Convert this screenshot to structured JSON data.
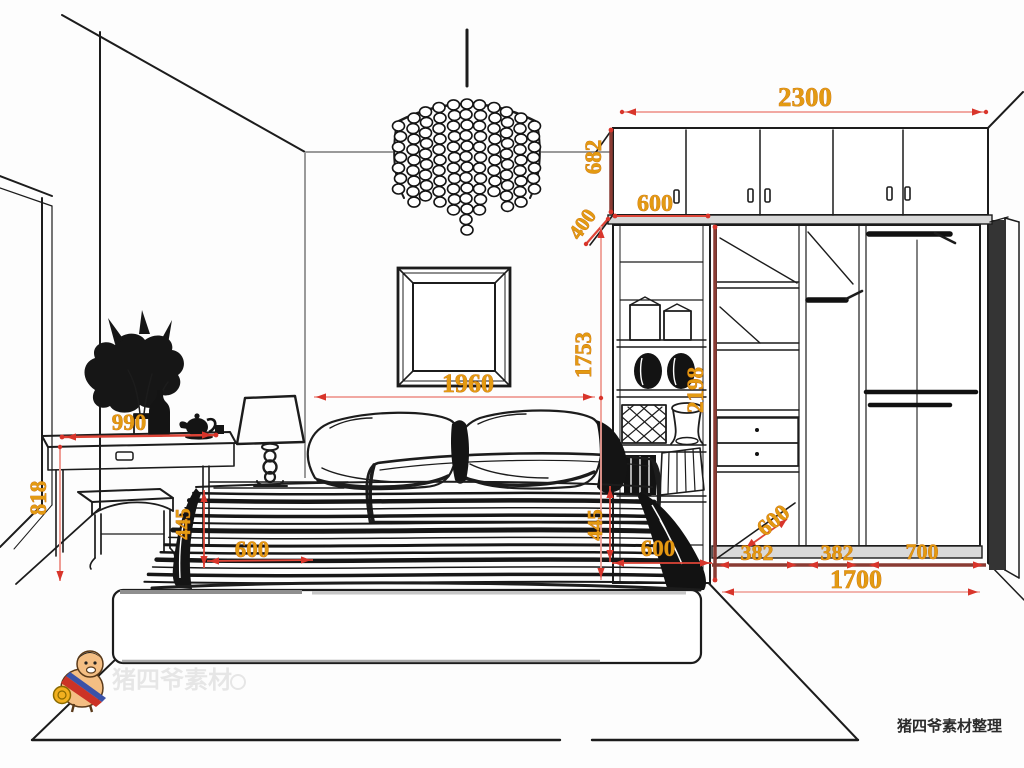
{
  "diagram": {
    "credit_text": "猪四爷素材整理",
    "watermark_text": "猪四爷素材",
    "dimensions": {
      "top_cabinet_width": "2300",
      "top_cabinet_height": "682",
      "bookshelf_width": "600",
      "top_cabinet_depth": "400",
      "bookshelf_height": "1753",
      "wardrobe_height": "2198",
      "bed_width": "1960",
      "dresser_width": "990",
      "dresser_height": "818",
      "bed_height_left": "445",
      "bed_inset_left": "600",
      "bed_height_right": "445",
      "bed_inset_right": "600",
      "wardrobe_depth": "600",
      "wardrobe_section_1": "382",
      "wardrobe_section_2": "382",
      "wardrobe_section_3": "700",
      "wardrobe_total_width": "1700"
    },
    "colors": {
      "dimension_text": "#E39A12",
      "dimension_line": "#DD4437",
      "dimension_line_pale": "#EF9C94",
      "dimension_strip": "#8A3B33",
      "ink": "#1C1C1C"
    }
  }
}
